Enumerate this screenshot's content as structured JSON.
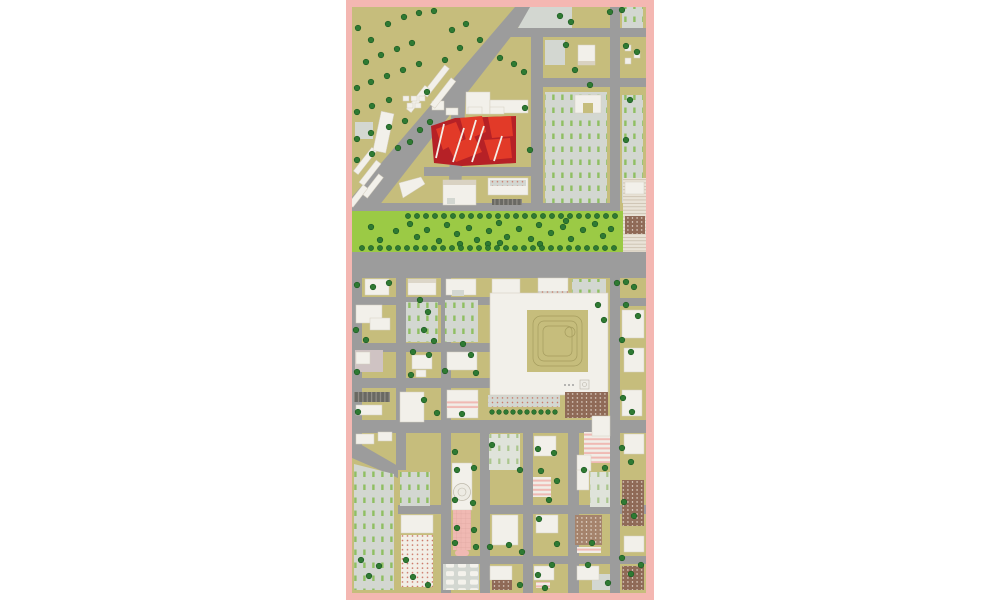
{
  "document": {
    "type_label": "Architectural urban site plan",
    "title": "Masterplan drawing with red highlighted intervention site, linear park and city grid"
  },
  "palette": {
    "white": "#ffffff",
    "pink_border": "#f4b7b2",
    "ground_olive": "#c6bd7c",
    "road_gray": "#9c9c9c",
    "park_green": "#9bca45",
    "tree_green": "#2f7a33",
    "tree_dark": "#1c5a22",
    "building_white": "#f2f0ea",
    "building_edge": "#d5cfc0",
    "lot_gray": "#d3d7d1",
    "dash_green": "#8fbf62",
    "red_bright": "#e23a28",
    "red_dark": "#b62126",
    "pink_building": "#f0b9b3",
    "brown_structure": "#8f6a57",
    "brown_light": "#a5836c",
    "dark_canopy": "#6a6963",
    "hatch_bg": "#e9e3d7",
    "hatch_line": "#c4b8a5",
    "courtyard_line": "#a59c5e",
    "dot_red": "#cb7868",
    "orchard_bg": "#f2eee6",
    "pale_lot": "#dfe3da",
    "pale_stripe": "#abc68e",
    "pink_grid_line": "#d9a09a"
  },
  "map": {
    "legend": [
      {
        "feature": "highlighted-project-site",
        "color": "red_bright"
      },
      {
        "feature": "central-linear-park",
        "color": "park_green"
      },
      {
        "feature": "streets-and-boulevard",
        "color": "road_gray"
      },
      {
        "feature": "ground",
        "color": "ground_olive"
      },
      {
        "feature": "buildings",
        "color": "building_white"
      },
      {
        "feature": "parking-lots",
        "color": "lot_gray"
      },
      {
        "feature": "trees",
        "color": "tree_green"
      },
      {
        "feature": "plan-border",
        "color": "pink_border"
      }
    ],
    "tree_rows": [
      {
        "x0": 408,
        "y": 216,
        "dx": 9,
        "n": 24,
        "r": 2.6
      },
      {
        "x0": 362,
        "y": 248,
        "dx": 9,
        "n": 29,
        "r": 2.6
      },
      {
        "x0": 492,
        "y": 412,
        "dx": 7,
        "n": 10,
        "r": 2.3
      }
    ],
    "trees": [
      [
        358,
        28
      ],
      [
        371,
        40
      ],
      [
        388,
        24
      ],
      [
        404,
        17
      ],
      [
        419,
        13
      ],
      [
        434,
        11
      ],
      [
        366,
        62
      ],
      [
        381,
        55
      ],
      [
        397,
        49
      ],
      [
        412,
        43
      ],
      [
        357,
        88
      ],
      [
        371,
        82
      ],
      [
        387,
        76
      ],
      [
        403,
        70
      ],
      [
        419,
        64
      ],
      [
        357,
        112
      ],
      [
        372,
        106
      ],
      [
        389,
        100
      ],
      [
        357,
        139
      ],
      [
        371,
        133
      ],
      [
        389,
        127
      ],
      [
        405,
        121
      ],
      [
        357,
        160
      ],
      [
        372,
        154
      ],
      [
        420,
        130
      ],
      [
        430,
        122
      ],
      [
        398,
        148
      ],
      [
        410,
        142
      ],
      [
        452,
        30
      ],
      [
        466,
        24
      ],
      [
        480,
        40
      ],
      [
        500,
        58
      ],
      [
        514,
        64
      ],
      [
        524,
        72
      ],
      [
        560,
        16
      ],
      [
        571,
        22
      ],
      [
        610,
        12
      ],
      [
        622,
        10
      ],
      [
        626,
        46
      ],
      [
        637,
        52
      ],
      [
        630,
        100
      ],
      [
        626,
        140
      ],
      [
        575,
        70
      ],
      [
        590,
        85
      ],
      [
        566,
        45
      ],
      [
        525,
        108
      ],
      [
        530,
        150
      ],
      [
        427,
        92
      ],
      [
        445,
        60
      ],
      [
        460,
        48
      ],
      [
        371,
        227
      ],
      [
        380,
        240
      ],
      [
        396,
        231
      ],
      [
        410,
        224
      ],
      [
        417,
        237
      ],
      [
        427,
        230
      ],
      [
        439,
        241
      ],
      [
        447,
        225
      ],
      [
        457,
        234
      ],
      [
        469,
        228
      ],
      [
        477,
        240
      ],
      [
        489,
        231
      ],
      [
        499,
        223
      ],
      [
        507,
        237
      ],
      [
        519,
        229
      ],
      [
        531,
        239
      ],
      [
        539,
        225
      ],
      [
        551,
        233
      ],
      [
        563,
        227
      ],
      [
        571,
        239
      ],
      [
        583,
        230
      ],
      [
        595,
        224
      ],
      [
        603,
        236
      ],
      [
        611,
        229
      ],
      [
        460,
        244
      ],
      [
        488,
        244
      ],
      [
        540,
        244
      ],
      [
        566,
        221
      ],
      [
        500,
        243
      ],
      [
        357,
        285
      ],
      [
        373,
        287
      ],
      [
        389,
        283
      ],
      [
        626,
        282
      ],
      [
        634,
        287
      ],
      [
        617,
        283
      ],
      [
        420,
        300
      ],
      [
        428,
        312
      ],
      [
        424,
        330
      ],
      [
        434,
        341
      ],
      [
        356,
        330
      ],
      [
        366,
        340
      ],
      [
        413,
        352
      ],
      [
        429,
        355
      ],
      [
        463,
        344
      ],
      [
        471,
        355
      ],
      [
        445,
        371
      ],
      [
        476,
        373
      ],
      [
        357,
        372
      ],
      [
        411,
        375
      ],
      [
        424,
        400
      ],
      [
        437,
        413
      ],
      [
        358,
        412
      ],
      [
        462,
        414
      ],
      [
        455,
        452
      ],
      [
        457,
        470
      ],
      [
        455,
        500
      ],
      [
        457,
        528
      ],
      [
        455,
        543
      ],
      [
        474,
        468
      ],
      [
        473,
        503
      ],
      [
        474,
        530
      ],
      [
        476,
        547
      ],
      [
        492,
        445
      ],
      [
        520,
        470
      ],
      [
        538,
        449
      ],
      [
        554,
        453
      ],
      [
        541,
        471
      ],
      [
        557,
        481
      ],
      [
        549,
        500
      ],
      [
        539,
        519
      ],
      [
        557,
        544
      ],
      [
        552,
        565
      ],
      [
        538,
        575
      ],
      [
        522,
        552
      ],
      [
        509,
        545
      ],
      [
        490,
        547
      ],
      [
        520,
        585
      ],
      [
        545,
        588
      ],
      [
        584,
        470
      ],
      [
        605,
        468
      ],
      [
        592,
        543
      ],
      [
        588,
        565
      ],
      [
        608,
        583
      ],
      [
        622,
        340
      ],
      [
        631,
        352
      ],
      [
        623,
        398
      ],
      [
        632,
        412
      ],
      [
        622,
        448
      ],
      [
        631,
        462
      ],
      [
        624,
        502
      ],
      [
        634,
        516
      ],
      [
        622,
        558
      ],
      [
        631,
        574
      ],
      [
        641,
        565
      ],
      [
        361,
        560
      ],
      [
        369,
        576
      ],
      [
        379,
        566
      ],
      [
        406,
        560
      ],
      [
        413,
        577
      ],
      [
        428,
        585
      ],
      [
        598,
        305
      ],
      [
        604,
        320
      ],
      [
        626,
        305
      ],
      [
        638,
        316
      ]
    ]
  }
}
